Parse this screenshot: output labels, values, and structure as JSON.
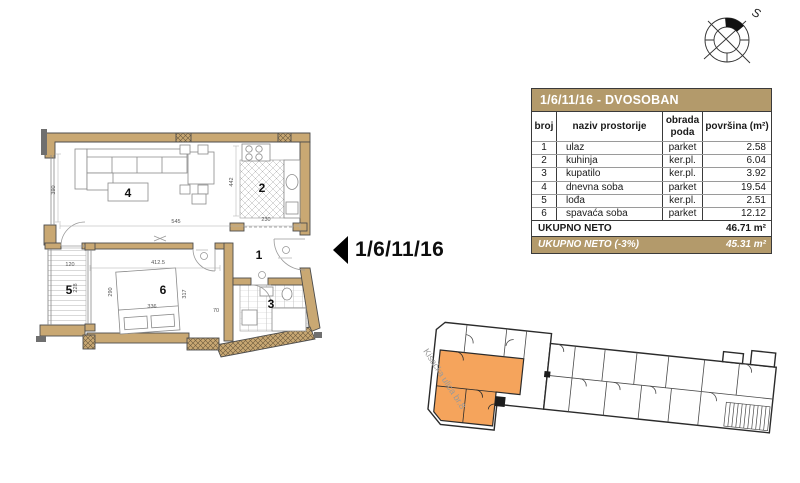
{
  "plan_callout": {
    "label": "1/6/11/16"
  },
  "compass": {
    "label": "S"
  },
  "table": {
    "title": "1/6/11/16 - DVOSOBAN",
    "columns": [
      "broj",
      "naziv prostorije",
      "obrada poda",
      "površina (m²)"
    ],
    "rows": [
      {
        "broj": "1",
        "naziv": "ulaz",
        "obrada": "parket",
        "povrsina": "2.58"
      },
      {
        "broj": "2",
        "naziv": "kuhinja",
        "obrada": "ker.pl.",
        "povrsina": "6.04"
      },
      {
        "broj": "3",
        "naziv": "kupatilo",
        "obrada": "ker.pl.",
        "povrsina": "3.92"
      },
      {
        "broj": "4",
        "naziv": "dnevna soba",
        "obrada": "parket",
        "povrsina": "19.54"
      },
      {
        "broj": "5",
        "naziv": "lođa",
        "obrada": "ker.pl.",
        "povrsina": "2.51"
      },
      {
        "broj": "6",
        "naziv": "spavaća soba",
        "obrada": "parket",
        "povrsina": "12.12"
      }
    ],
    "total_label": "UKUPNO NETO",
    "total_value": "46.71 m²",
    "net_label": "UKUPNO NETO (-3%)",
    "net_value": "45.31 m²"
  },
  "floor_plan": {
    "room_numbers": {
      "r1": "1",
      "r2": "2",
      "r3": "3",
      "r4": "4",
      "r5": "5",
      "r6": "6"
    },
    "dimensions": {
      "d545": "545",
      "d442": "442",
      "d230": "230",
      "d390": "390",
      "d120": "120",
      "d4125": "412.5",
      "d290": "290",
      "d317": "317",
      "d336": "336",
      "d70": "70",
      "d228": "228"
    }
  },
  "site_plan": {
    "street_label": "Kisačka ulica br.8"
  },
  "colors": {
    "accent_tan": "#b39a6b",
    "wall_tan": "#c9a873",
    "highlight_orange": "#f5a45c"
  }
}
